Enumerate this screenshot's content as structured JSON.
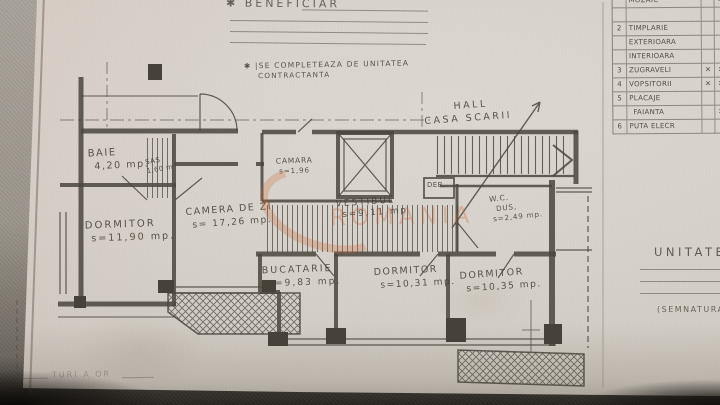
{
  "header": {
    "beneficiar": "✱ BENEFICIAR",
    "note1": "✱ |SE COMPLETEAZA  DE UNITATEA",
    "note2": "CONTRACTANTA"
  },
  "finish_table": {
    "rows": [
      {
        "no": "",
        "label": "MOZAIC",
        "m1": "",
        "m2": "✕"
      },
      {
        "no": "",
        "label": "",
        "m1": "",
        "m2": ""
      },
      {
        "no": "2",
        "label": "TIMPLARIE",
        "m1": "",
        "m2": ""
      },
      {
        "no": "",
        "label": "EXTERIOARA",
        "m1": "",
        "m2": ""
      },
      {
        "no": "",
        "label": "INTERIOARA",
        "m1": "",
        "m2": ""
      },
      {
        "no": "3",
        "label": "ZUGRAVELI",
        "m1": "✕",
        "m2": "✕"
      },
      {
        "no": "4",
        "label": "VOPSITORII",
        "m1": "✕",
        "m2": "✕"
      },
      {
        "no": "5",
        "label": "PLACAJE",
        "m1": "",
        "m2": ""
      },
      {
        "no": "",
        "label": "FAIANTA",
        "m1": "",
        "m2": "✕"
      },
      {
        "no": "6",
        "label": "PUTA ELECR",
        "m1": "",
        "m2": ""
      }
    ]
  },
  "rooms": {
    "baie": {
      "l1": "BAIE",
      "l2": "4,20 mp."
    },
    "sas": {
      "l1": "SAS",
      "l2": "1,60 m"
    },
    "dormitor1": {
      "l1": "DORMITOR",
      "l2": "s=11,90 mp."
    },
    "camera_zi": {
      "l1": "CAMERA DE ZI",
      "l2": "s= 17,26 mp."
    },
    "camara": {
      "l1": "CAMARA",
      "l2": "s=1,96"
    },
    "vestibul": {
      "l1": "VESTIBUL",
      "l2": "s=9,11 mp"
    },
    "hall": {
      "l1": "HALL",
      "l2": "CASA SCARII"
    },
    "deb": {
      "l1": "DEB."
    },
    "wc": {
      "l1": "W.C.",
      "l2": "DUS,",
      "l3": "s=2,49 mp."
    },
    "bucatarie": {
      "l1": "BUCATARIE",
      "l2": "s=9,83 mp."
    },
    "dormitor2": {
      "l1": "DORMITOR",
      "l2": "s=10,31 mp."
    },
    "dormitor3": {
      "l1": "DORMITOR",
      "l2": "s=10,35 mp."
    }
  },
  "right_panel": {
    "title": "UNITATE CO",
    "signature": "(SEMNATURA"
  },
  "footer": {
    "pencil_note": "TURI A OR"
  },
  "watermark": {
    "text": "ROMANIA",
    "color": "#c75f2e"
  }
}
